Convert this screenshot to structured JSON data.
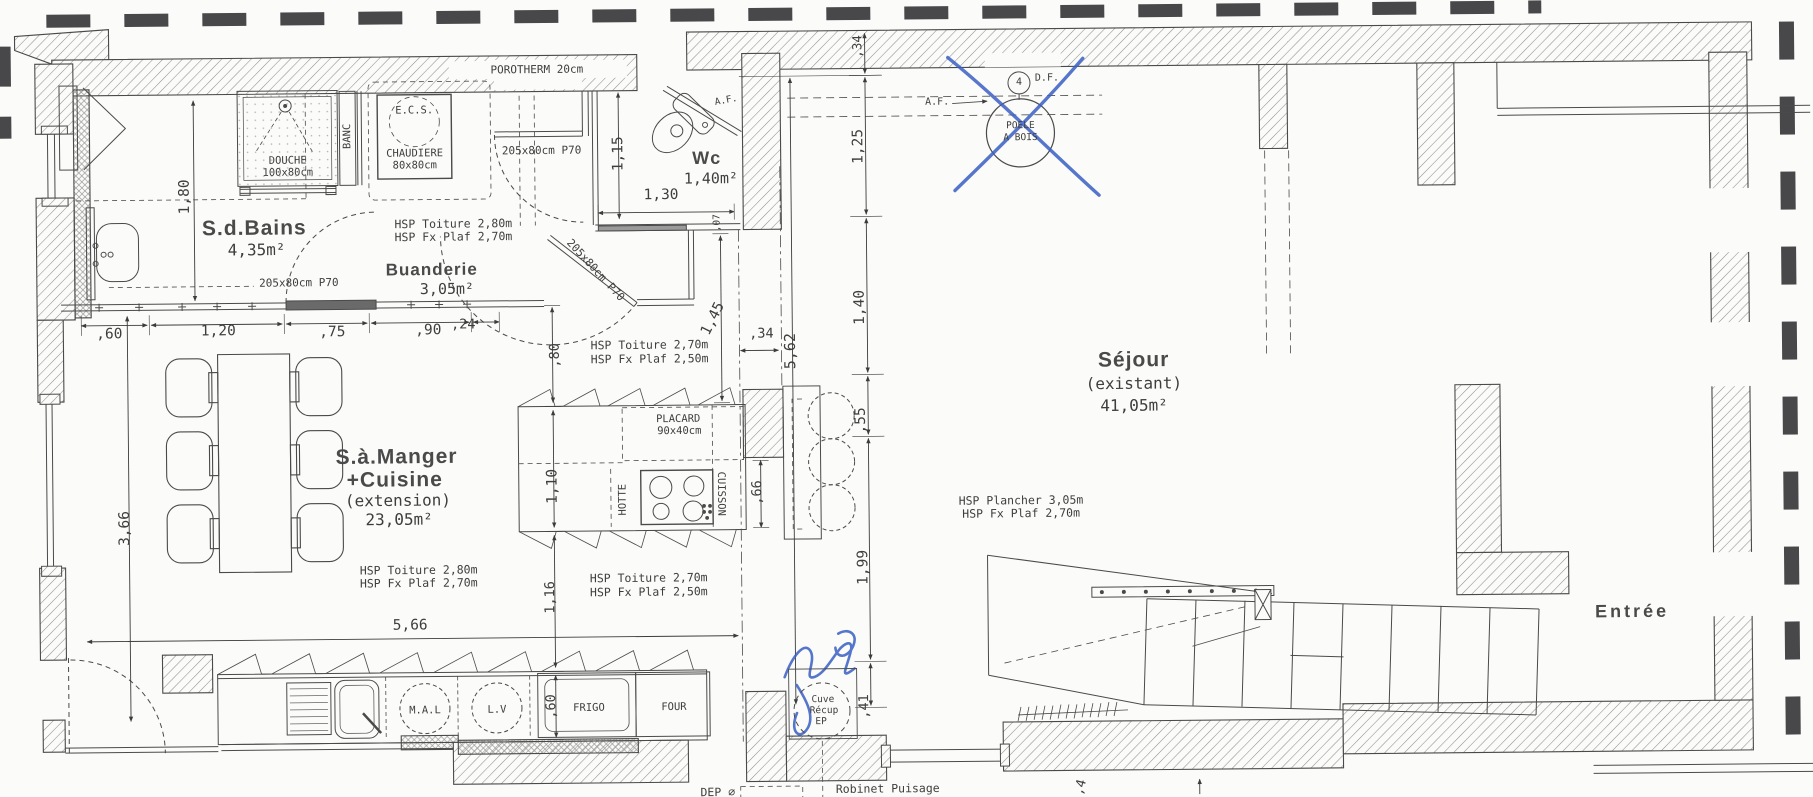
{
  "meta": {
    "drawing_type": "architectural floor plan",
    "language": "fr"
  },
  "colors": {
    "paper": "#fbfbf9",
    "ink": "#3e3e3e",
    "wall_hatch": "#8f8f8f",
    "bold_dash": "#48484b",
    "pen_blue": "#3a5fc5"
  },
  "rooms": [
    {
      "name": "S.d.Bains",
      "area": "4,35m²"
    },
    {
      "name": "Buanderie",
      "area": "3,05m²"
    },
    {
      "name": "Wc",
      "area": "1,40m²"
    },
    {
      "name": "S.à.Manger +Cuisine",
      "status": "(extension)",
      "area": "23,05m²"
    },
    {
      "name": "Séjour",
      "status": "(existant)",
      "area": "41,05m²"
    },
    {
      "name": "Entrée"
    }
  ],
  "annotations": {
    "pen_color": "#3a5fc5",
    "items": [
      {
        "id": "pen-cross-poele",
        "kind": "cross-out",
        "target": "POELE A BOIS"
      },
      {
        "id": "pen-scribble-cuve",
        "kind": "handwriting",
        "target": "Cuve Récup EP"
      }
    ]
  },
  "labels": [
    {
      "id": "room-sdbains-title",
      "text": "S.d.Bains",
      "x": 256,
      "y": 222,
      "s": 21,
      "b": 1
    },
    {
      "id": "room-sdbains-area",
      "text": "4,35m²",
      "x": 258,
      "y": 244,
      "s": 16
    },
    {
      "id": "room-buanderie-title",
      "text": "Buanderie",
      "x": 433,
      "y": 265,
      "s": 17,
      "b": 1
    },
    {
      "id": "room-buanderie-area",
      "text": "3,05m²",
      "x": 448,
      "y": 285,
      "s": 15
    },
    {
      "id": "room-wc-title",
      "text": "Wc",
      "x": 709,
      "y": 156,
      "s": 18,
      "b": 1
    },
    {
      "id": "room-wc-area",
      "text": "1,40m²",
      "x": 713,
      "y": 177,
      "s": 15
    },
    {
      "id": "room-sam-line1",
      "text": "S.à.Manger",
      "x": 396,
      "y": 452,
      "s": 21,
      "b": 1
    },
    {
      "id": "room-sam-line2",
      "text": "+Cuisine",
      "x": 394,
      "y": 475,
      "s": 21,
      "b": 1
    },
    {
      "id": "room-sam-ext",
      "text": "(extension)",
      "x": 397,
      "y": 496,
      "s": 16
    },
    {
      "id": "room-sam-area",
      "text": "23,05m²",
      "x": 398,
      "y": 515,
      "s": 16
    },
    {
      "id": "room-sejour-title",
      "text": "Séjour",
      "x": 1134,
      "y": 362,
      "s": 21,
      "b": 1
    },
    {
      "id": "room-sejour-sub",
      "text": "(existant)",
      "x": 1134,
      "y": 386,
      "s": 16
    },
    {
      "id": "room-sejour-area",
      "text": "41,05m²",
      "x": 1134,
      "y": 408,
      "s": 16
    },
    {
      "id": "room-entree-title",
      "text": "Entrée",
      "x": 1630,
      "y": 618,
      "s": 18,
      "b": 1,
      "ls": 3
    },
    {
      "id": "wall-porotherm",
      "text": "POROTHERM 20cm",
      "x": 540,
      "y": 66,
      "s": 11,
      "bg": 1
    },
    {
      "id": "fixture-douche",
      "text": "DOUCHE",
      "x": 290,
      "y": 155,
      "s": 10.5
    },
    {
      "id": "fixture-douche-size",
      "text": "100x80cm",
      "x": 290,
      "y": 167,
      "s": 10.5
    },
    {
      "id": "fixture-banc",
      "text": "BANC",
      "x": 350,
      "y": 131,
      "s": 10.5,
      "rot": -90
    },
    {
      "id": "fixture-ecs",
      "text": "E.C.S.",
      "x": 417,
      "y": 106,
      "s": 10.5
    },
    {
      "id": "fixture-chaudiere",
      "text": "CHAUDIERE",
      "x": 417,
      "y": 149,
      "s": 10.5
    },
    {
      "id": "fixture-chaudiere-size",
      "text": "80x80cm",
      "x": 417,
      "y": 161,
      "s": 10.5
    },
    {
      "id": "fixture-placard",
      "text": "PLACARD",
      "x": 678,
      "y": 417,
      "s": 10.5
    },
    {
      "id": "fixture-placard-size",
      "text": "90x40cm",
      "x": 679,
      "y": 429,
      "s": 10.5
    },
    {
      "id": "fixture-hotte",
      "text": "HOTTE",
      "x": 622,
      "y": 497,
      "s": 10.5,
      "rot": -90
    },
    {
      "id": "fixture-cuisson",
      "text": "CUISSON",
      "x": 720,
      "y": 492,
      "s": 10.5,
      "rot": 90
    },
    {
      "id": "appliance-mal",
      "text": "M.A.L",
      "x": 422,
      "y": 706,
      "s": 10.5
    },
    {
      "id": "appliance-lv",
      "text": "L.V",
      "x": 494,
      "y": 706,
      "s": 10.5
    },
    {
      "id": "appliance-frigo",
      "text": "FRIGO",
      "x": 586,
      "y": 705,
      "s": 10.5
    },
    {
      "id": "appliance-four",
      "text": "FOUR",
      "x": 671,
      "y": 705,
      "s": 10.5
    },
    {
      "id": "cuve-line1",
      "text": "Cuve",
      "x": 820,
      "y": 699,
      "s": 9.5
    },
    {
      "id": "cuve-line2",
      "text": "Récup",
      "x": 821,
      "y": 710,
      "s": 9.5
    },
    {
      "id": "cuve-line3",
      "text": "EP",
      "x": 818,
      "y": 721,
      "s": 9.5
    },
    {
      "id": "note-dep",
      "text": "DEP ⌀",
      "x": 714,
      "y": 791,
      "s": 11.5
    },
    {
      "id": "note-robinet",
      "text": "Robinet Puisage",
      "x": 884,
      "y": 789,
      "s": 11.5
    },
    {
      "id": "poele-line1",
      "text": "POELE",
      "x": 1023,
      "y": 127,
      "s": 9.5
    },
    {
      "id": "poele-line2",
      "text": "A BOIS",
      "x": 1023,
      "y": 139,
      "s": 9.5
    },
    {
      "id": "vent-df",
      "text": "D.F.",
      "x": 1050,
      "y": 80,
      "s": 10
    },
    {
      "id": "vent-df-num",
      "text": "4",
      "x": 1022,
      "y": 84,
      "s": 10
    },
    {
      "id": "window-af-wc",
      "text": "A.F.",
      "x": 729,
      "y": 99,
      "s": 9.5,
      "rot": -10
    },
    {
      "id": "window-af-sejour",
      "text": "A.F.",
      "x": 940,
      "y": 103,
      "s": 10
    },
    {
      "id": "door-bath-label",
      "text": "205x80cm P70",
      "x": 300,
      "y": 277,
      "s": 11
    },
    {
      "id": "door-buanderie-top-label",
      "text": "205x80cm P70",
      "x": 544,
      "y": 147,
      "s": 11
    },
    {
      "id": "door-buanderie-diag-label",
      "text": "205x80cm P70",
      "x": 597,
      "y": 267,
      "s": 11,
      "rot": 48
    },
    {
      "id": "hsp-buanderie-1",
      "text": "HSP Toiture 2,80m",
      "x": 455,
      "y": 220,
      "s": 11.5
    },
    {
      "id": "hsp-buanderie-2",
      "text": "HSP Fx Plaf 2,70m",
      "x": 455,
      "y": 233,
      "s": 11.5
    },
    {
      "id": "hsp-kitchen-north-1",
      "text": "HSP Toiture 2,70m",
      "x": 650,
      "y": 343,
      "s": 11.5
    },
    {
      "id": "hsp-kitchen-north-2",
      "text": "HSP Fx Plaf 2,50m",
      "x": 650,
      "y": 357,
      "s": 11.5
    },
    {
      "id": "hsp-sam-1",
      "text": "HSP Toiture 2,80m",
      "x": 417,
      "y": 566,
      "s": 11.5
    },
    {
      "id": "hsp-sam-2",
      "text": "HSP Fx Plaf 2,70m",
      "x": 417,
      "y": 579,
      "s": 11.5
    },
    {
      "id": "hsp-kitchen-south-1",
      "text": "HSP Toiture 2,70m",
      "x": 647,
      "y": 576,
      "s": 11.5
    },
    {
      "id": "hsp-kitchen-south-2",
      "text": "HSP Fx Plaf 2,50m",
      "x": 647,
      "y": 590,
      "s": 11.5
    },
    {
      "id": "hsp-sejour-1",
      "text": "HSP Plancher 3,05m",
      "x": 1020,
      "y": 502,
      "s": 11.5
    },
    {
      "id": "hsp-sejour-2",
      "text": "HSP Fx Plaf 2,70m",
      "x": 1020,
      "y": 515,
      "s": 11.5
    },
    {
      "id": "dim-1-80",
      "text": "1,80",
      "x": 187,
      "y": 190,
      "s": 14.5,
      "rot": -90
    },
    {
      "id": "dim-0-60-a",
      "text": ",60",
      "x": 110,
      "y": 327,
      "s": 14.5
    },
    {
      "id": "dim-1-20",
      "text": "1,20",
      "x": 219,
      "y": 325,
      "s": 14.5
    },
    {
      "id": "dim-0-75",
      "text": ",75",
      "x": 333,
      "y": 327,
      "s": 14.5
    },
    {
      "id": "dim-0-90",
      "text": ",90",
      "x": 429,
      "y": 326,
      "s": 14.5
    },
    {
      "id": "dim-0-24",
      "text": ",24",
      "x": 464,
      "y": 321,
      "s": 13.5
    },
    {
      "id": "dim-1-15",
      "text": "1,15",
      "x": 621,
      "y": 151,
      "s": 14.5,
      "rot": -90
    },
    {
      "id": "dim-1-30",
      "text": "1,30",
      "x": 663,
      "y": 193,
      "s": 14.5
    },
    {
      "id": "dim-0-07",
      "text": ",07",
      "x": 719,
      "y": 221,
      "s": 9.5,
      "rot": -90
    },
    {
      "id": "dim-3-66",
      "text": "3,66",
      "x": 124,
      "y": 521,
      "s": 14.5,
      "rot": -90
    },
    {
      "id": "dim-5-66",
      "text": "5,66",
      "x": 408,
      "y": 621,
      "s": 14.5
    },
    {
      "id": "dim-0-80",
      "text": ",80",
      "x": 556,
      "y": 352,
      "s": 13.5,
      "rot": -90
    },
    {
      "id": "dim-1-10",
      "text": "1,10",
      "x": 552,
      "y": 483,
      "s": 14.5,
      "rot": -90
    },
    {
      "id": "dim-1-16",
      "text": "1,16",
      "x": 549,
      "y": 594,
      "s": 13.5,
      "rot": -90
    },
    {
      "id": "dim-0-60-b",
      "text": ",60",
      "x": 549,
      "y": 703,
      "s": 13.5,
      "rot": -90
    },
    {
      "id": "dim-1-45",
      "text": "1,45",
      "x": 714,
      "y": 317,
      "s": 14.5,
      "rot": -63
    },
    {
      "id": "dim-0-34-a",
      "text": ",34",
      "x": 762,
      "y": 333,
      "s": 13.5
    },
    {
      "id": "dim-0-66",
      "text": ",66",
      "x": 757,
      "y": 491,
      "s": 13.5,
      "rot": -90
    },
    {
      "id": "dim-0-34-b",
      "text": ",34",
      "x": 861,
      "y": 46,
      "s": 12.5,
      "rot": -90
    },
    {
      "id": "dim-1-25",
      "text": "1,25",
      "x": 861,
      "y": 146,
      "s": 14.5,
      "rot": -90
    },
    {
      "id": "dim-1-40",
      "text": "1,40",
      "x": 861,
      "y": 307,
      "s": 14.5,
      "rot": -90
    },
    {
      "id": "dim-0-55",
      "text": ",55",
      "x": 861,
      "y": 420,
      "s": 14.5,
      "rot": -90
    },
    {
      "id": "dim-1-99",
      "text": "1,99",
      "x": 862,
      "y": 567,
      "s": 14.5,
      "rot": -90
    },
    {
      "id": "dim-0-41",
      "text": ",41",
      "x": 862,
      "y": 706,
      "s": 13.5,
      "rot": -90
    },
    {
      "id": "dim-5-62",
      "text": "5,62",
      "x": 791,
      "y": 350,
      "s": 15,
      "rot": -90
    },
    {
      "id": "dim-0-4-partial",
      "text": ",4",
      "x": 1077,
      "y": 789,
      "s": 13,
      "rot": -75
    }
  ]
}
